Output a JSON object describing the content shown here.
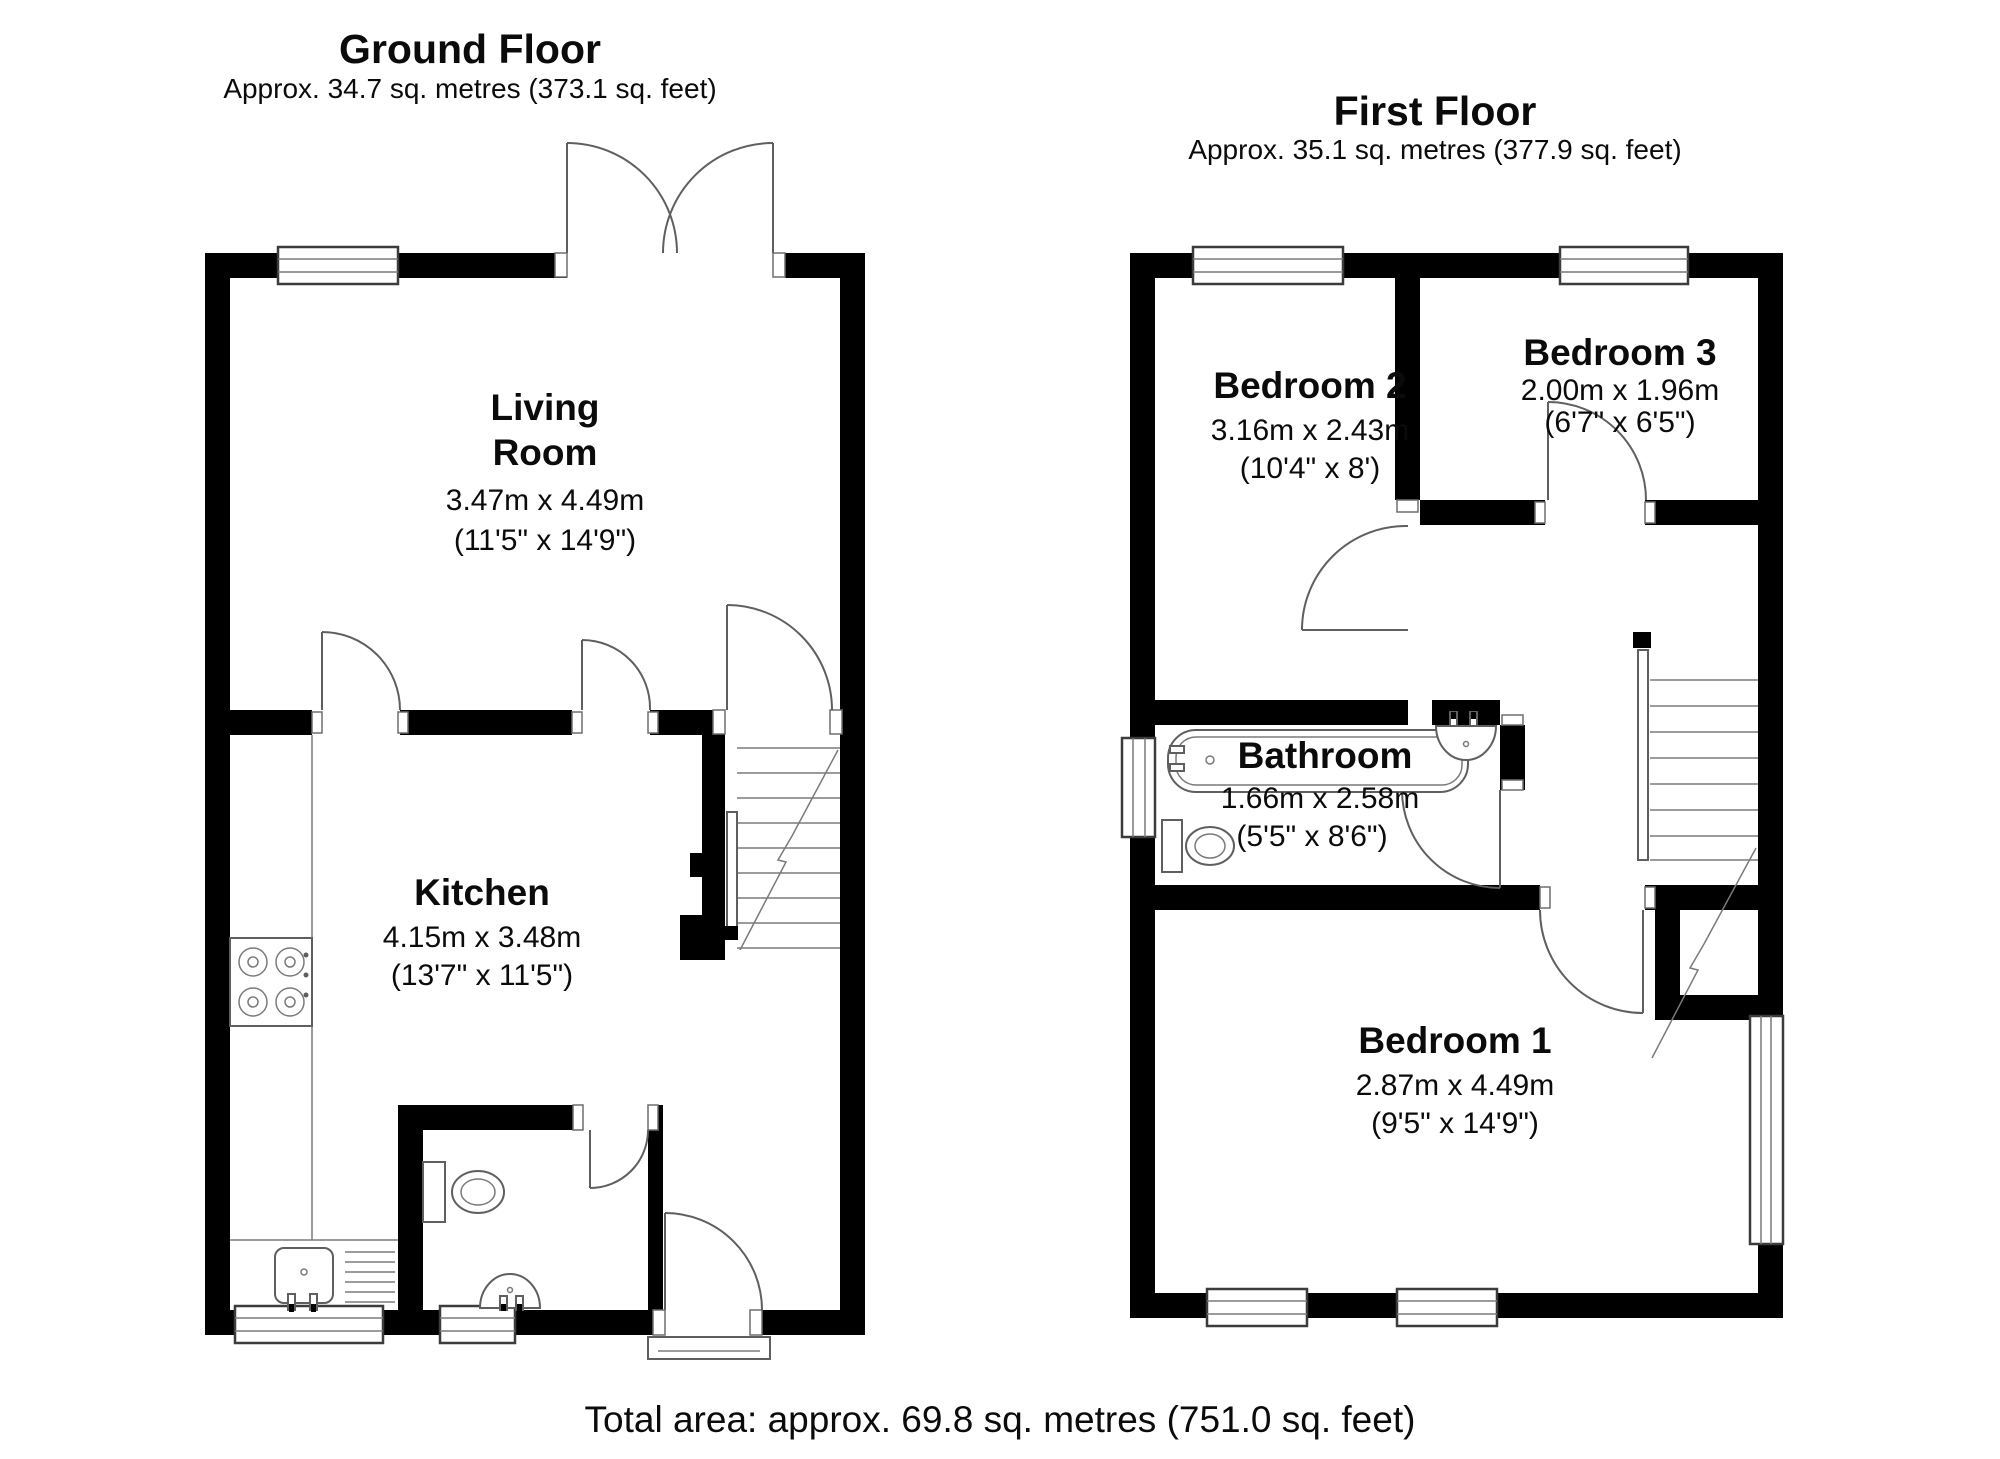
{
  "ground_floor": {
    "title": "Ground Floor",
    "area_label": "Approx. 34.7 sq. metres (373.1 sq. feet)",
    "rooms": {
      "living_room": {
        "line1": "Living",
        "line2": "Room",
        "metric": "3.47m x 4.49m",
        "imperial": "(11'5\" x 14'9\")"
      },
      "kitchen": {
        "name": "Kitchen",
        "metric": "4.15m x 3.48m",
        "imperial": "(13'7\" x 11'5\")"
      }
    }
  },
  "first_floor": {
    "title": "First Floor",
    "area_label": "Approx. 35.1 sq. metres (377.9 sq. feet)",
    "rooms": {
      "bedroom2": {
        "name": "Bedroom 2",
        "metric": "3.16m x 2.43m",
        "imperial": "(10'4\" x 8')"
      },
      "bedroom3": {
        "name": "Bedroom 3",
        "metric": "2.00m x 1.96m",
        "imperial": "(6'7\" x 6'5\")"
      },
      "bathroom": {
        "name": "Bathroom",
        "metric": "1.66m x 2.58m",
        "imperial": "(5'5\" x 8'6\")"
      },
      "bedroom1": {
        "name": "Bedroom 1",
        "metric": "2.87m x 4.49m",
        "imperial": "(9'5\" x 14'9\")"
      }
    }
  },
  "footer": {
    "total_area": "Total area: approx. 69.8 sq. metres (751.0 sq. feet)"
  },
  "colors": {
    "wall": "#000000",
    "line": "#5f5f5f",
    "background": "#ffffff"
  }
}
